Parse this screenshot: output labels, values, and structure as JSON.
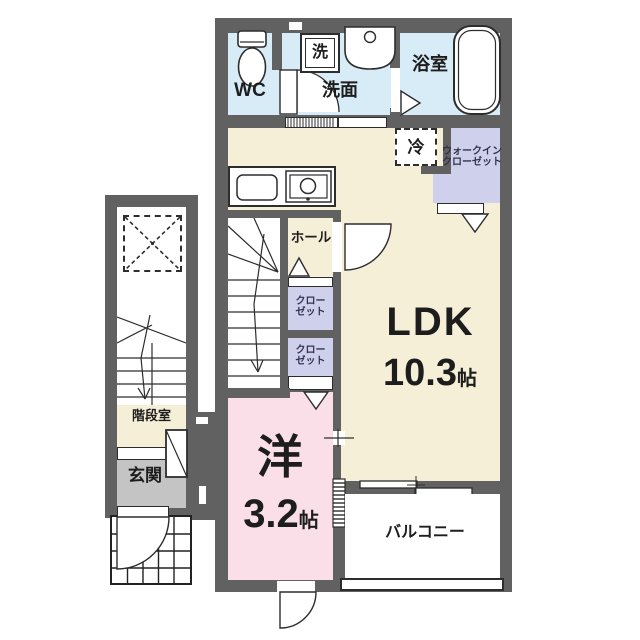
{
  "colors": {
    "wall": "#616161",
    "water": "#d8ecf7",
    "cream": "#f6efd8",
    "lavender": "#cfd0ec",
    "pink": "#fbdfe8",
    "egray": "#c4c4c4",
    "line": "#2d2d2d"
  },
  "rooms": {
    "wc": {
      "label": "WC"
    },
    "washroom": {
      "label": "洗面"
    },
    "washer": {
      "label": "洗"
    },
    "bathroom": {
      "label": "浴室"
    },
    "refrigerator": {
      "label": "冷"
    },
    "walk_in_closet": {
      "line1": "ウォークイン",
      "line2": "クローゼット"
    },
    "hall": {
      "label": "ホール"
    },
    "closet_upper": {
      "line1": "クロー",
      "line2": "ゼット"
    },
    "closet_lower": {
      "line1": "クロー",
      "line2": "ゼット"
    },
    "ldk": {
      "label": "LDK",
      "size": "10.3",
      "unit": "帖"
    },
    "western_room": {
      "label": "洋",
      "size": "3.2",
      "unit": "帖"
    },
    "balcony": {
      "label": "バルコニー"
    },
    "stairwell": {
      "label": "階段室"
    },
    "entrance": {
      "label": "玄関"
    }
  }
}
